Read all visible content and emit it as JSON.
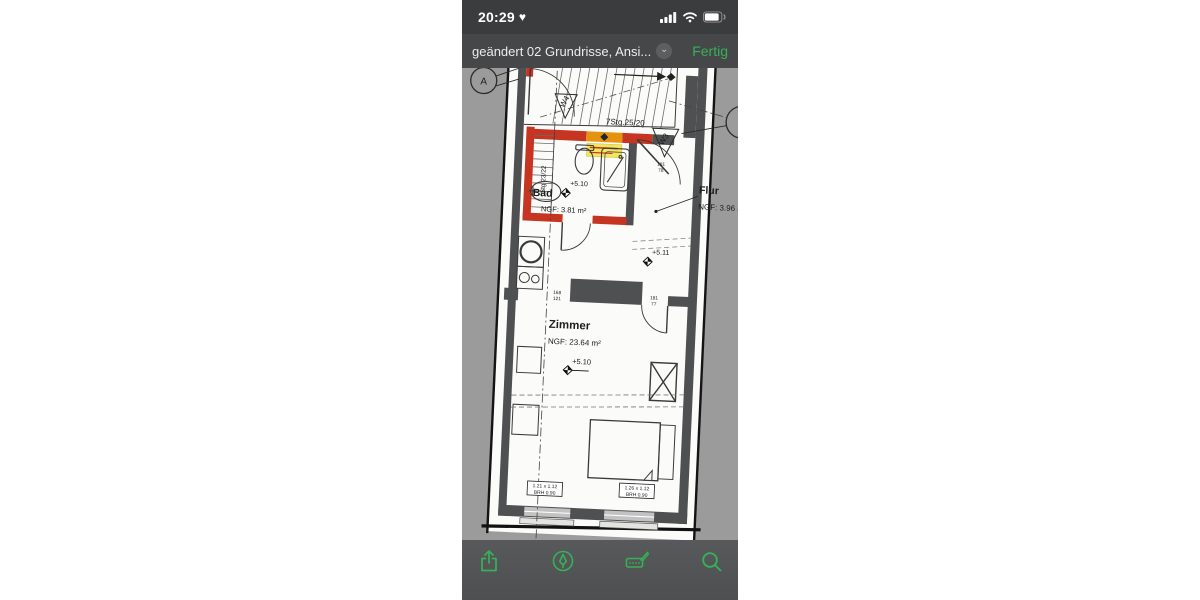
{
  "status_bar": {
    "time": "20:29",
    "heart": "♥"
  },
  "title_bar": {
    "title": "geändert 02 Grundrisse, Ansi...",
    "done_label": "Fertig"
  },
  "toolbar": {
    "icons": [
      {
        "name": "share-icon"
      },
      {
        "name": "markup-icon"
      },
      {
        "name": "sign-icon"
      },
      {
        "name": "search-icon"
      }
    ]
  },
  "plan": {
    "rooms": [
      {
        "name": "Bad",
        "area": "NGF: 3.81 m²",
        "level": "+5.10"
      },
      {
        "name": "Flur",
        "area": "NGF: 3.96 m²",
        "level": "+5.11"
      },
      {
        "name": "Zimmer",
        "area": "NGF: 23.64 m²",
        "level": "+5.10"
      }
    ],
    "stairs": {
      "upper": "7Stg.25/20",
      "lower": "Stg 23/22"
    },
    "markers": {
      "section": "A",
      "w3": "W3",
      "w4": "W4"
    },
    "openings": [
      {
        "w": "168",
        "h": "121"
      },
      {
        "w": "181",
        "h": "77"
      },
      {
        "w": "181",
        "h": "78"
      }
    ],
    "windows": [
      {
        "size": "1.21 x 1.12",
        "sill": "BRH 0.90"
      },
      {
        "size": "1.26 x 1.12",
        "sill": "BRH 0.90"
      }
    ],
    "colors": {
      "wall": "#4f5051",
      "highlight_red": "#c53522",
      "highlight_orange": "#e5930f",
      "highlight_yellow": "#f3e65f",
      "sheet_background": "#9b9b9b",
      "accent_green": "#35b257"
    }
  }
}
